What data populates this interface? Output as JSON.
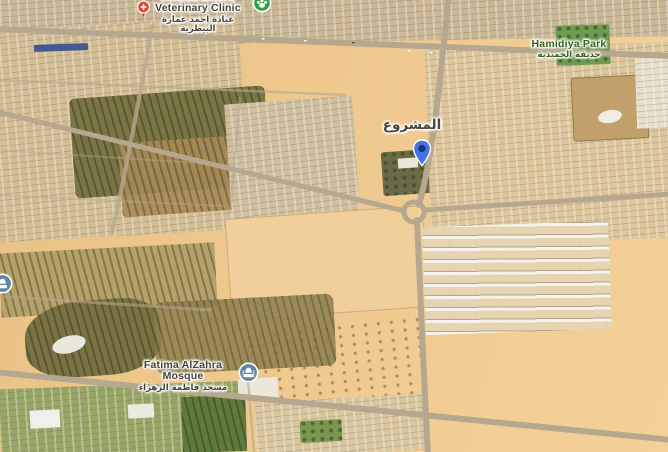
{
  "map": {
    "view_type": "satellite-3d-oblique",
    "pois": {
      "vet_clinic": {
        "line1": "Ahmed Emara",
        "line2": "Veterinary Clinic",
        "arabic": "عيادة احمد عمارة البيطرية",
        "icon": "medical-cross-pin",
        "pin_color": "#e94335"
      },
      "pet_place": {
        "icon": "paw-badge",
        "badge_color": "#2f9e44"
      },
      "park": {
        "name": "Hamidiya Park",
        "arabic": "حديقة الحميدية",
        "label_color": "#33601c"
      },
      "district": {
        "arabic": "المشروع"
      },
      "destination": {
        "icon": "location-pin",
        "pin_color": "#4274e0",
        "pin_inner": "#16307e"
      },
      "mosque": {
        "name": "Fatima AlZahra Mosque",
        "arabic": "مسجد فاطمة الزهراء",
        "icon": "mosque-badge",
        "badge_color": "#5f87a3"
      },
      "edge_poi": {
        "icon": "mosque-badge",
        "badge_color": "#5f87a3"
      }
    },
    "terrain_colors": {
      "sand": "#eec88c",
      "road": "#b6a88e",
      "park_green": "#6e9b4f",
      "farm_olive": "#7a7544",
      "urban_tan": "#d3bd95",
      "housing_white": "#f6f4ed"
    }
  }
}
